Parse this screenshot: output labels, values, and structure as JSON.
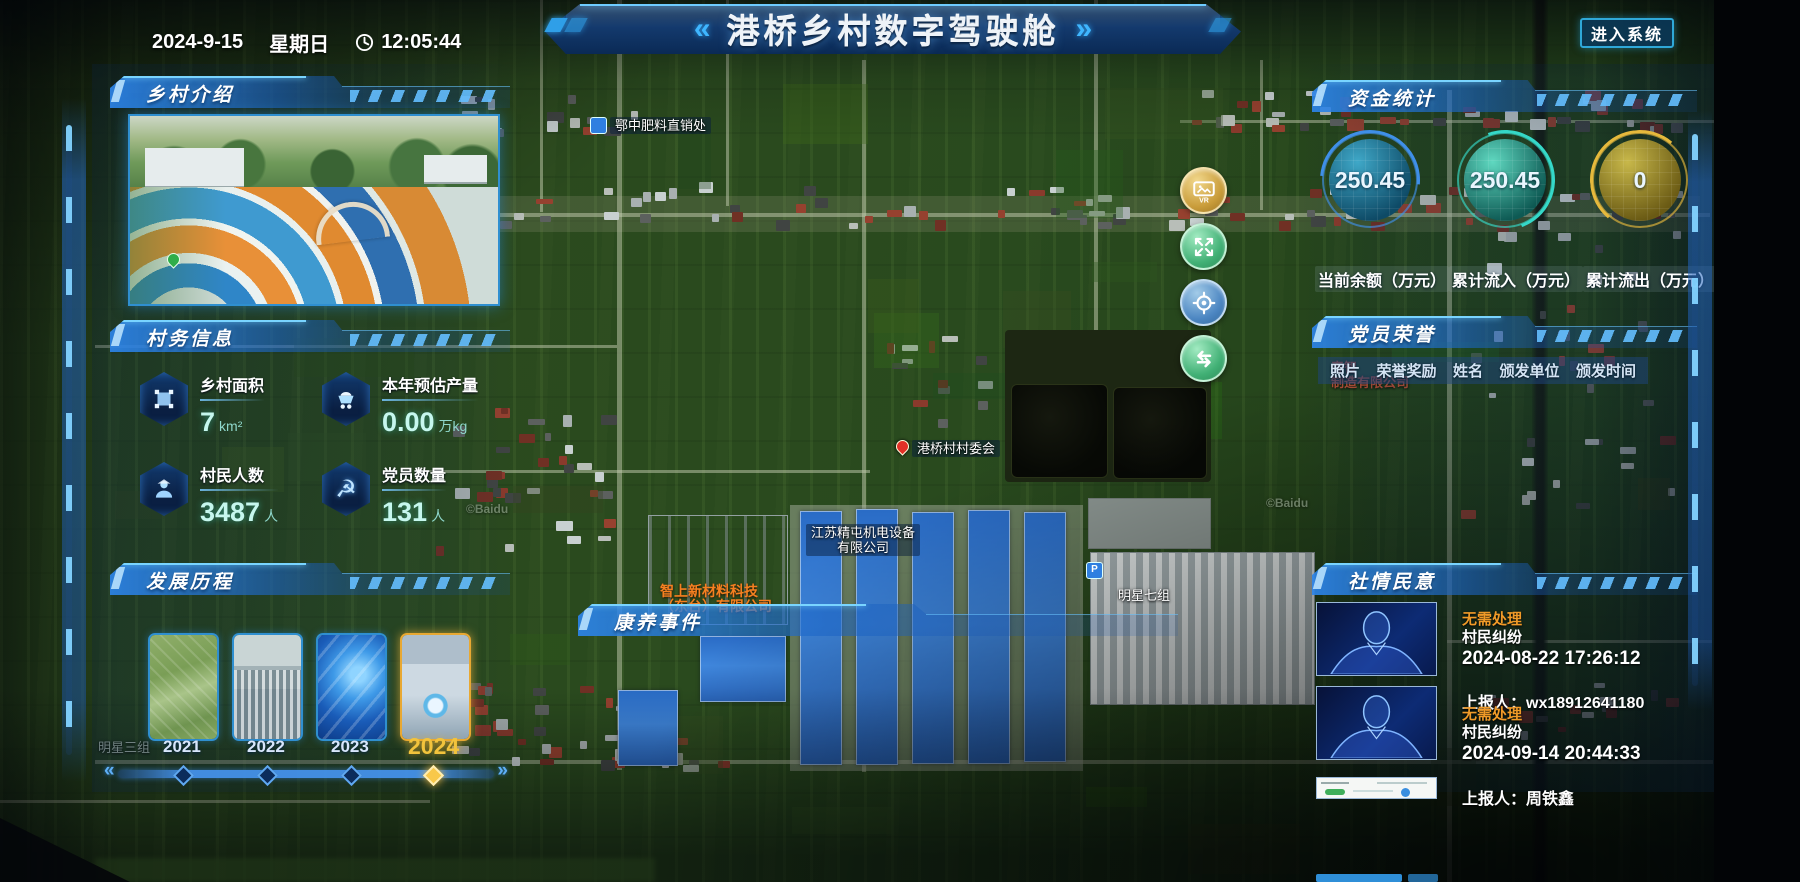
{
  "header": {
    "title": "港桥乡村数字驾驶舱",
    "chev_left": "«",
    "chev_right": "»",
    "date": "2024-9-15",
    "weekday": "星期日",
    "time": "12:05:44",
    "enter_button": "进入系统"
  },
  "panels": {
    "intro": {
      "title": "乡村介绍"
    },
    "village_info": {
      "title": "村务信息",
      "stats": [
        {
          "icon": "area-icon",
          "label": "乡村面积",
          "value": "7",
          "unit": "km²"
        },
        {
          "icon": "cart-icon",
          "label": "本年预估产量",
          "value": "0.00",
          "unit": "万kg"
        },
        {
          "icon": "people-icon",
          "label": "村民人数",
          "value": "3487",
          "unit": "人"
        },
        {
          "icon": "party-icon",
          "label": "党员数量",
          "value": "131",
          "unit": "人"
        }
      ]
    },
    "history": {
      "title": "发展历程",
      "years": [
        {
          "label": "2021",
          "active": false
        },
        {
          "label": "2022",
          "active": false
        },
        {
          "label": "2023",
          "active": false
        },
        {
          "label": "2024",
          "active": true
        }
      ]
    },
    "funds": {
      "title": "资金统计",
      "gauges": [
        {
          "value": "250.45",
          "label": "当前余额（万元）",
          "color": "#2f7fd8"
        },
        {
          "value": "250.45",
          "label": "累计流入（万元）",
          "color": "#35d8c8"
        },
        {
          "value": "0",
          "label": "累计流出（万元）",
          "color": "#e0b23a"
        }
      ]
    },
    "honors": {
      "title": "党员荣誉",
      "columns": [
        "照片",
        "荣誉奖励",
        "姓名",
        "颁发单位",
        "颁发时间"
      ]
    },
    "sentiment": {
      "title": "社情民意",
      "status_color": "#f09a28",
      "items": [
        {
          "status": "无需处理",
          "type": "村民纠纷",
          "time": "2024-08-22 17:26:12",
          "reporter": "上报人：wx18912641180"
        },
        {
          "status": "无需处理",
          "type": "村民纠纷",
          "time": "2024-09-14 20:44:33",
          "reporter": "上报人：周铁鑫"
        }
      ]
    },
    "health": {
      "title": "康养事件"
    }
  },
  "map": {
    "labels": [
      {
        "line1": "鄂中肥料直销处"
      },
      {
        "line1": "港桥村村委会"
      },
      {
        "line1": "江苏精屯机电设备",
        "line2": "有限公司"
      },
      {
        "line1": "明星七组"
      },
      {
        "line1": "P"
      },
      {
        "line1": "智上新材料科技",
        "line2": "（东台）有限公司"
      },
      {
        "line1": "明星三组"
      },
      {
        "line1": "春智",
        "line2": "制造有限公司"
      },
      {
        "line1": "©Baidu"
      },
      {
        "line1": "©Baidu"
      }
    ],
    "controls": [
      {
        "icon": "vr-photo-icon"
      },
      {
        "icon": "fullscreen-icon"
      },
      {
        "icon": "locate-icon"
      },
      {
        "icon": "layer-switch-icon"
      }
    ]
  }
}
